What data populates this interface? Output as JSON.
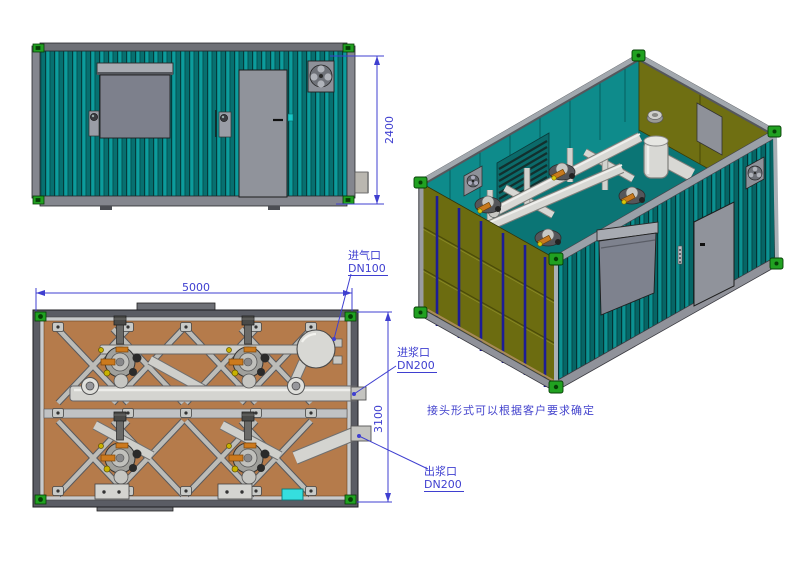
{
  "drawing": {
    "type": "containerized-pump-station-cad-drawing",
    "views": {
      "side_elevation": "side-elevation",
      "plan": "plan-view",
      "isometric": "isometric-view"
    }
  },
  "dimensions": {
    "height": "2400",
    "length": "5000",
    "width": "3100"
  },
  "labels": {
    "air_inlet": {
      "line1": "进气口",
      "line2": "DN100"
    },
    "slurry_inlet": {
      "line1": "进浆口",
      "line2": "DN200"
    },
    "slurry_outlet": {
      "line1": "出浆口",
      "line2": "DN200"
    },
    "note": "接头形式可以根据客户要求确定"
  },
  "colors": {
    "annotation_blue": "#3f3fd0",
    "wall_teal_dark": "#077070",
    "wall_teal_light": "#0c9a9a",
    "end_door_olive": "#6c6c10",
    "floor_brown": "#b57b4b",
    "frame_gray": "#8e9096",
    "pipe_gray": "#d6d6d2",
    "corner_casting_green": "#21a121",
    "electric_box_cyan": "#35dede",
    "door_gray": "#90939b"
  }
}
